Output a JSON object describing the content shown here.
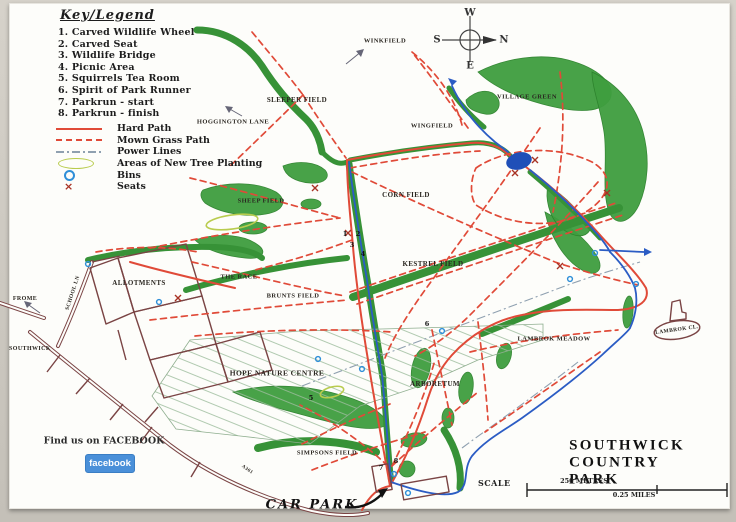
{
  "key": {
    "title": "Key/Legend",
    "items": [
      "1.  Carved Wildlife Wheel",
      "2.  Carved Seat",
      "3.  Wildlife Bridge",
      "4.  Picnic Area",
      "5.  Squirrels Tea Room",
      "6.  Spirit of Park Runner",
      "7.  Parkrun  -  start",
      "8.  Parkrun  -  finish"
    ]
  },
  "legend": {
    "items": [
      {
        "label": "Hard Path",
        "symbol": "solid-red-line"
      },
      {
        "label": "Mown Grass Path",
        "symbol": "dashed-red-line"
      },
      {
        "label": "Power Lines",
        "symbol": "dash-dot-grey-line"
      },
      {
        "label": "Areas of New Tree Planting",
        "symbol": "green-ellipse-outline"
      },
      {
        "label": "Bins",
        "symbol": "blue-circle"
      },
      {
        "label": "Seats",
        "symbol": "red-x"
      }
    ]
  },
  "compass": {
    "west": "W",
    "south": "S",
    "north": "N",
    "east": "E"
  },
  "map_labels": {
    "winkfield": "WINKFIELD",
    "sleeper_field": "SLEEPER FIELD",
    "hoggington_lane": "HOGGINGTON LANE",
    "wingfield": "WINGFIELD",
    "village_green": "VILLAGE GREEN",
    "sheep_field": "SHEEP FIELD",
    "corn_field": "CORN FIELD",
    "kestrel_field": "KESTREL FIELD",
    "the_race": "THE RACE",
    "brunts_field": "BRUNTS FIELD",
    "allotments": "ALLOTMENTS",
    "frome": "FROME",
    "southwick": "SOUTHWICK",
    "school_lane": "SCHOOL LN",
    "lambrok_meadow": "LAMBROK MEADOW",
    "lambrok_close": "LAMBROK CL.",
    "hope_nature_centre": "HOPE NATURE CENTRE",
    "arboretum": "ARBORETUM",
    "simpsons_field": "SIMPSONS FIELD",
    "car_park": "CAR PARK",
    "a361": "A361"
  },
  "markers": {
    "m1": "1",
    "m2": "2",
    "m3": "3",
    "m4": "4",
    "m5": "5",
    "m6": "6",
    "m7": "7",
    "m8": "8"
  },
  "facebook": {
    "prompt": "Find us on FACEBOOK",
    "button_label": "facebook"
  },
  "footer": {
    "title": "SOUTHWICK COUNTRY PARK",
    "scale_label": "SCALE",
    "scale_metres": "250 METRES",
    "scale_miles": "0.25 MILES"
  },
  "colors": {
    "hard_path": "#e04a38",
    "mown_grass_path": "#e04a38",
    "power_lines": "#8fa0b0",
    "tree_planting": "#b9cc4e",
    "bins": "#2f8fd8",
    "seats": "#a83224",
    "stream": "#2b5cc4",
    "road": "#7a4444",
    "woodland": "#3f9e3f",
    "facebook_blue": "#4a90d9"
  }
}
